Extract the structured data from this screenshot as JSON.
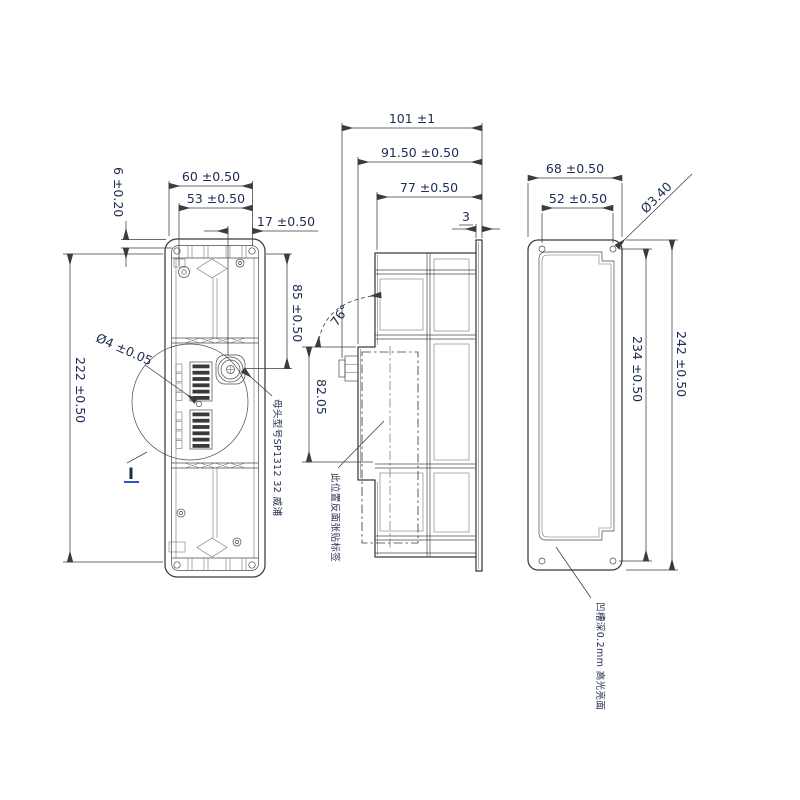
{
  "drawing": {
    "kind": "mechanical-part-three-view-drawing",
    "colors": {
      "line": "#3a3a3a",
      "dimension_text": "#1c2b52",
      "accent": "#2f55c9",
      "background": "#ffffff"
    },
    "front_view": {
      "dims": {
        "width_top": "60 ±0.50",
        "width_mid": "53 ±0.50",
        "connector_offset": "17 ±0.50",
        "edge_offset": "6 ±0.20",
        "connector_depth": "85 ±0.50",
        "height": "222 ±0.50",
        "hole_diameter": "Ø4 ±0.05",
        "detail_label": "I",
        "connector_note": "母头型号SP1312 32 威浦"
      }
    },
    "side_view": {
      "dims": {
        "total_depth": "101 ±1",
        "body_depth": "91.50 ±0.50",
        "inner_depth": "77 ±0.50",
        "flange_thickness": "3",
        "window_height": "82.05",
        "tilt_angle": "76°",
        "label_note": "此位置反面张贴标签"
      }
    },
    "back_view": {
      "dims": {
        "width": "68 ±0.50",
        "hole_spacing_width": "52 ±0.50",
        "hole_diameter": "Ø3.40",
        "height": "242 ±0.50",
        "hole_spacing_height": "234 ±0.50",
        "groove_note": "凹槽深0.2mm 高光亮面"
      }
    }
  }
}
